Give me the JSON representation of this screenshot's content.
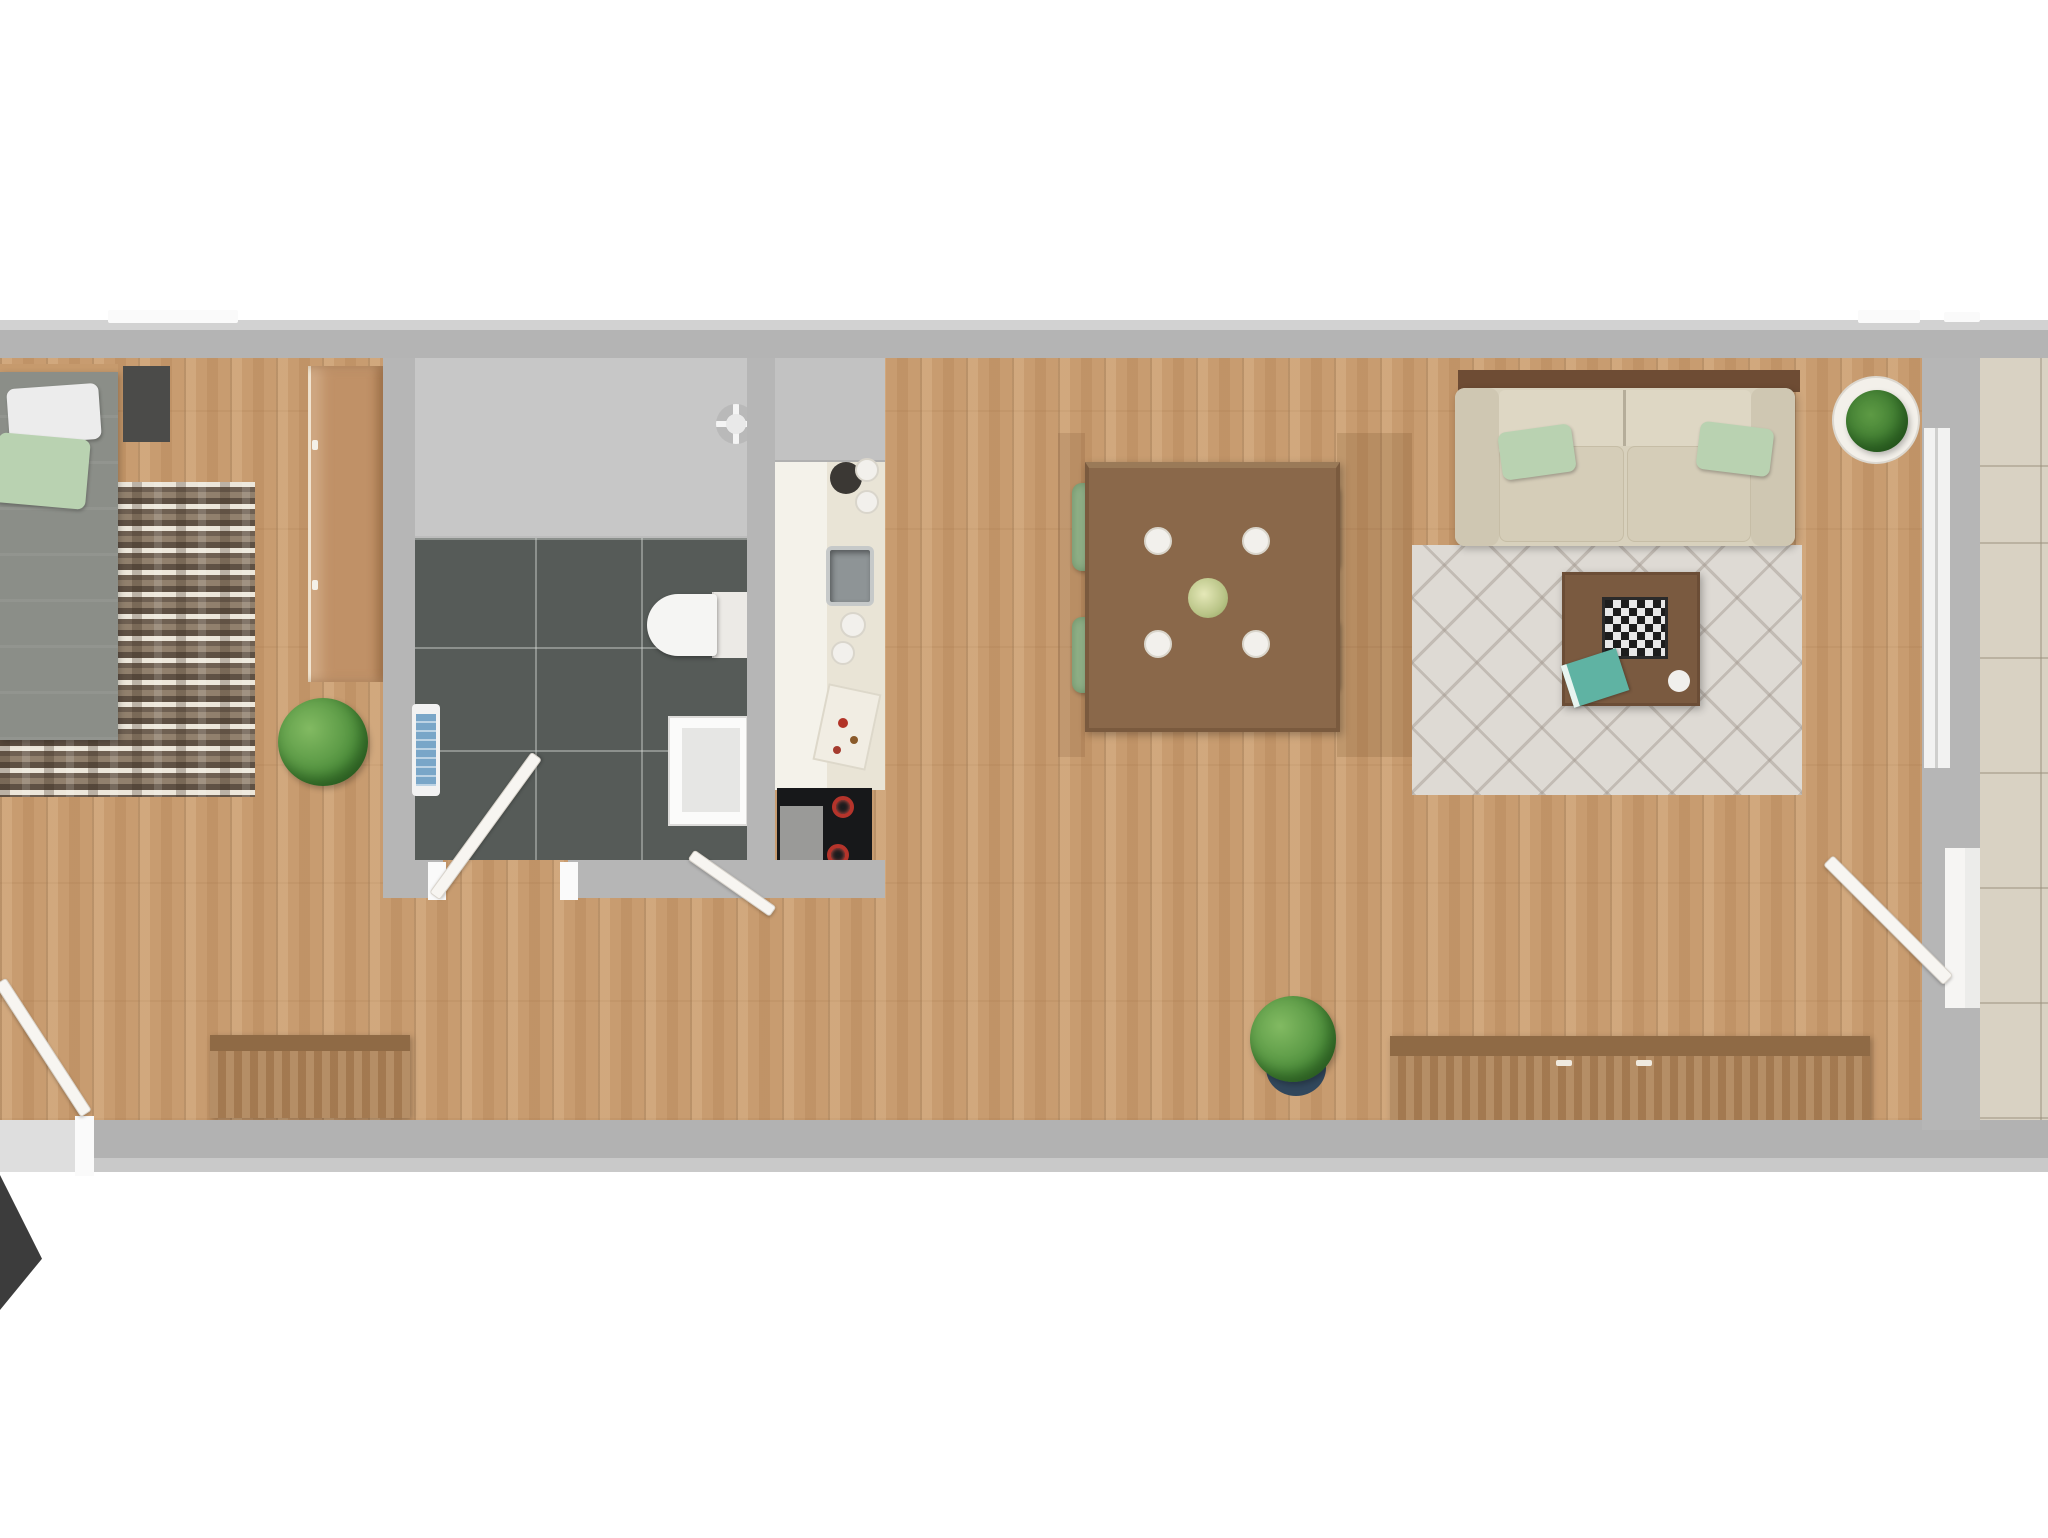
{
  "scene": {
    "kind": "apartment floor plan, top-down 3D render",
    "background": "#ffffff",
    "text_labels": []
  },
  "palette": {
    "wall_gray": "#b6b6b6",
    "wood_floor": "#c89c70",
    "bath_tile_dark": "#565b58",
    "shower_gray": "#c7c7c7",
    "balcony_tile": "#d9d2c3",
    "chair_green": "#92b289",
    "pillow_green": "#b9d2b1",
    "sofa_beige": "#d8d1bd",
    "living_rug": "#dedad4",
    "bedroom_rug_brown": "#7b6a58",
    "table_brown": "#8a684a",
    "dresser_wood": "#ab8158",
    "navy_pot": "#31475c",
    "radiator_blue": "#79a6c8",
    "book_teal": "#5fb3a3",
    "arrow_black": "#3c3c3c"
  },
  "rooms": [
    {
      "id": "bedroom",
      "furniture": [
        "double bed with white and green pillows",
        "dark nightstand",
        "wooden wardrobe",
        "striped rug",
        "potted plant",
        "wooden dresser"
      ]
    },
    {
      "id": "bathroom",
      "furniture": [
        "walk-in shower",
        "toilet",
        "vanity unit",
        "blue wall radiator",
        "dark floor tiles"
      ]
    },
    {
      "id": "kitchen",
      "furniture": [
        "tall cabinet",
        "counter",
        "steel sink",
        "cooktop with red burners",
        "cutting board with food",
        "plates"
      ]
    },
    {
      "id": "dining_area",
      "furniture": [
        "wooden dining table",
        "4 green chairs",
        "4 white plates",
        "plant centerpiece"
      ]
    },
    {
      "id": "living_room",
      "furniture": [
        "beige sofa with 2 green pillows",
        "wall console",
        "coffee table",
        "chessboard",
        "teal book",
        "diamond-pattern rug",
        "plant in white pot",
        "long wooden sideboard",
        "plant in navy pot"
      ]
    },
    {
      "id": "balcony",
      "furniture": [
        "large beige floor tiles"
      ]
    },
    {
      "id": "hallway",
      "furniture": [
        "entry door with swing",
        "black entrance arrow"
      ]
    }
  ],
  "counts": {
    "dining_chairs": 4,
    "dining_plates": 4,
    "sofa_pillows": 2,
    "bed_pillows": 2,
    "plants": 4,
    "doors": 4,
    "windows": 2
  }
}
